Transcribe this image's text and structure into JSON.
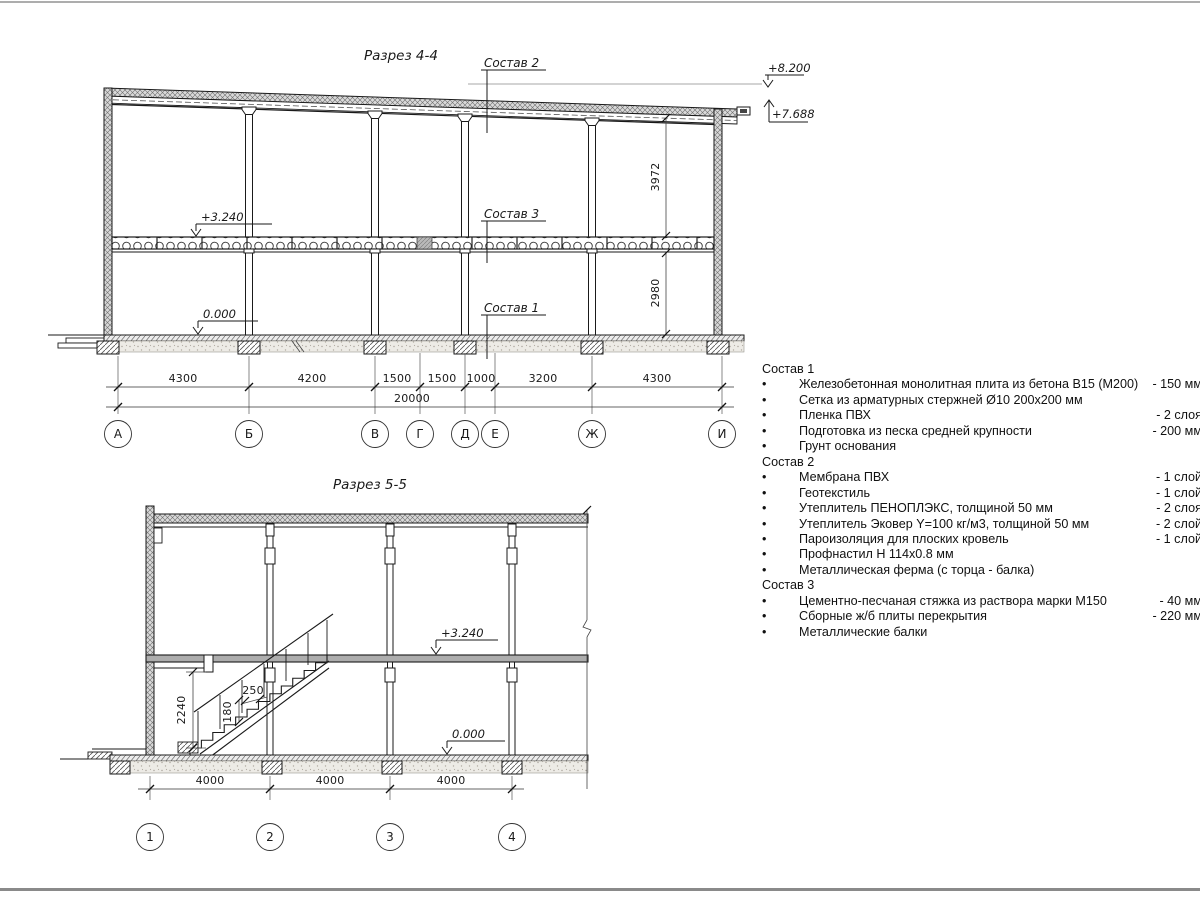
{
  "s44": {
    "title": "Разрез 4-4",
    "label_sostav2": "Состав 2",
    "label_sostav3": "Состав 3",
    "label_sostav1": "Состав 1",
    "elev_top": "+8.200",
    "elev_low": "+7.688",
    "elev_floor": "+3.240",
    "elev_zero": "0.000",
    "dim_upper": "3972",
    "dim_lower": "2980",
    "dims": [
      "4300",
      "4200",
      "1500",
      "1500",
      "1000",
      "3200",
      "4300"
    ],
    "dim_total": "20000",
    "axes": [
      "А",
      "Б",
      "В",
      "Г",
      "Д",
      "Е",
      "Ж",
      "И"
    ]
  },
  "s55": {
    "title": "Разрез 5-5",
    "elev_floor": "+3.240",
    "elev_zero": "0.000",
    "dim_height": "2240",
    "dim_tread": "250",
    "dim_riser": "180",
    "dims": [
      "4000",
      "4000",
      "4000"
    ],
    "axes": [
      "1",
      "2",
      "3",
      "4"
    ]
  },
  "materials": {
    "bullet": "•",
    "groups": [
      {
        "title": "Состав 1",
        "items": [
          {
            "name": "Железобетонная монолитная плита из бетона В15 (М200)",
            "value": "-  150 мм"
          },
          {
            "name": "Сетка из арматурных стержней Ø10 200x200 мм",
            "value": ""
          },
          {
            "name": "Пленка ПВХ",
            "value": "-  2 слоя"
          },
          {
            "name": "Подготовка из песка средней крупности",
            "value": "- 200 мм"
          },
          {
            "name": "Грунт основания",
            "value": ""
          }
        ]
      },
      {
        "title": "Состав 2",
        "items": [
          {
            "name": "Мембрана ПВХ",
            "value": "- 1 слой"
          },
          {
            "name": "Геотекстиль",
            "value": "- 1 слой"
          },
          {
            "name": "Утеплитель ПЕНОПЛЭКС, толщиной 50 мм",
            "value": "- 2 слоя"
          },
          {
            "name": "Утеплитель Эковер Y=100 кг/м3, толщиной 50 мм",
            "value": "- 2 слой"
          },
          {
            "name": "Пароизоляция для плоских кровель",
            "value": "- 1 слой"
          },
          {
            "name": "Профнастил Н 114x0.8 мм",
            "value": ""
          },
          {
            "name": "Металлическая ферма (с торца - балка)",
            "value": ""
          }
        ]
      },
      {
        "title": "Состав 3",
        "items": [
          {
            "name": "Цементно-песчаная стяжка из раствора марки М150",
            "value": "-  40 мм"
          },
          {
            "name": "Сборные ж/б плиты перекрытия",
            "value": "- 220 мм"
          },
          {
            "name": "Металлические балки",
            "value": ""
          }
        ]
      }
    ]
  }
}
